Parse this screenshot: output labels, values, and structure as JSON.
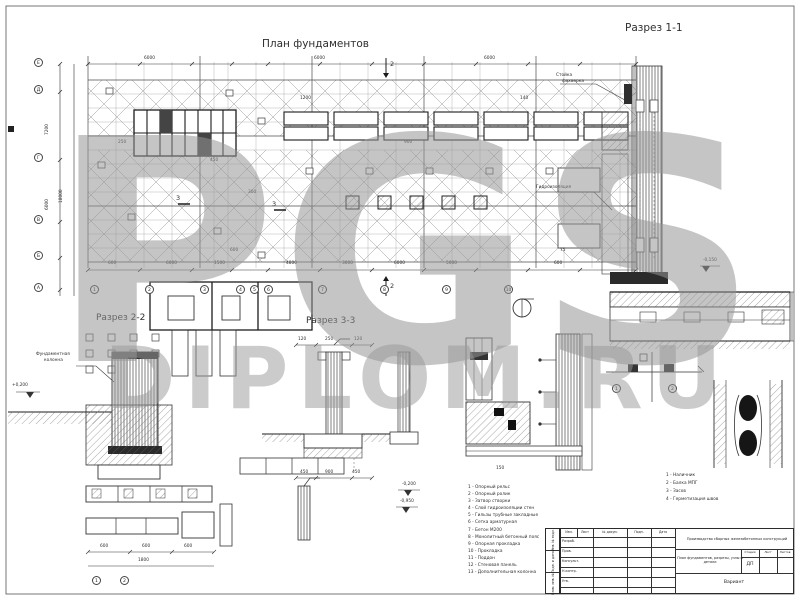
{
  "watermark": {
    "top": "PGS",
    "bottom": "DIPLOM.RU"
  },
  "plan": {
    "title": "План фундаментов",
    "bottom_axes": [
      "1",
      "2",
      "3",
      "4",
      "5",
      "6",
      "7",
      "8",
      "9",
      "10"
    ],
    "left_axes": [
      "Е",
      "Д",
      "Г",
      "В",
      "Б",
      "А"
    ],
    "bottom_dims": [
      "600",
      "6000",
      "1500",
      "4800",
      "3000",
      "6000",
      "5000",
      "600"
    ],
    "top_dims": [
      "6000",
      "6000",
      "6000"
    ],
    "left_dims": [
      "7200",
      "6000",
      "18000"
    ],
    "small_dims": [
      "300",
      "1200",
      "450",
      "250",
      "900",
      "140",
      "600",
      "75"
    ],
    "cut_mark_2": "2",
    "cut_mark_3": "3"
  },
  "section1": {
    "title": "Разрез 1-1",
    "leader_line1": "Стойка",
    "leader_line2": "фахверка",
    "hydro_label": "Гидроизоляция",
    "elevation": "-0,150"
  },
  "section2": {
    "title": "Разрез 2-2",
    "leader_line1": "Фундаментная",
    "leader_line2": "колонна",
    "elevation": "+0,200"
  },
  "section3": {
    "title": "Разрез 3-3",
    "top_dims": [
      "120",
      "250",
      "120"
    ],
    "bottom_dims": [
      "450",
      "900",
      "450"
    ],
    "elevation1": "-0,200",
    "elevation2": "-0,950"
  },
  "detail_center": {
    "dim": "150"
  },
  "detail_right": {
    "bubbles": [
      "1",
      "2"
    ]
  },
  "detail_bl": {
    "dims": [
      "600",
      "600",
      "600"
    ],
    "total": "1800",
    "bubbles": [
      "1",
      "2"
    ]
  },
  "legend_main": {
    "items": [
      "1 - Опорный рельс",
      "2 - Опорный ролик",
      "3 - Затвор створки",
      "4 - Слой гидроизоляции стен",
      "5 - Гильзы трубные закладные",
      "6 - Сетка арматурная",
      "7 - Бетон М200",
      "8 - Монолитный бетонный пояс",
      "9 - Опорная прокладка",
      "10 - Прокладка",
      "11 - Поддон",
      "12 - Стеновая панель",
      "13 - Дополнительная колонна"
    ]
  },
  "legend_small": {
    "items": [
      "1 - Наличник",
      "2 - Балка МПГ",
      "3 - Засов",
      "4 - Герметизация швов"
    ]
  },
  "stamp": {
    "header": [
      "Изм.",
      "Лист",
      "№ докум.",
      "Подп.",
      "Дата"
    ],
    "rows": [
      "Разраб.",
      "Пров.",
      "Консульт.",
      "Н.контр.",
      "Утв."
    ],
    "doc_title": "Производство сборных железобетонных конструкций",
    "sheet_title": "План фундаментов, разрезы, узлы и детали",
    "stage_label": "Стадия",
    "sheet_label": "Лист",
    "sheets_label": "Листов",
    "stage_value": "ДП",
    "org": "Вариант",
    "side_labels": [
      "Инв. № подл.",
      "Подп. и дата",
      "Взам. инв. №"
    ]
  }
}
